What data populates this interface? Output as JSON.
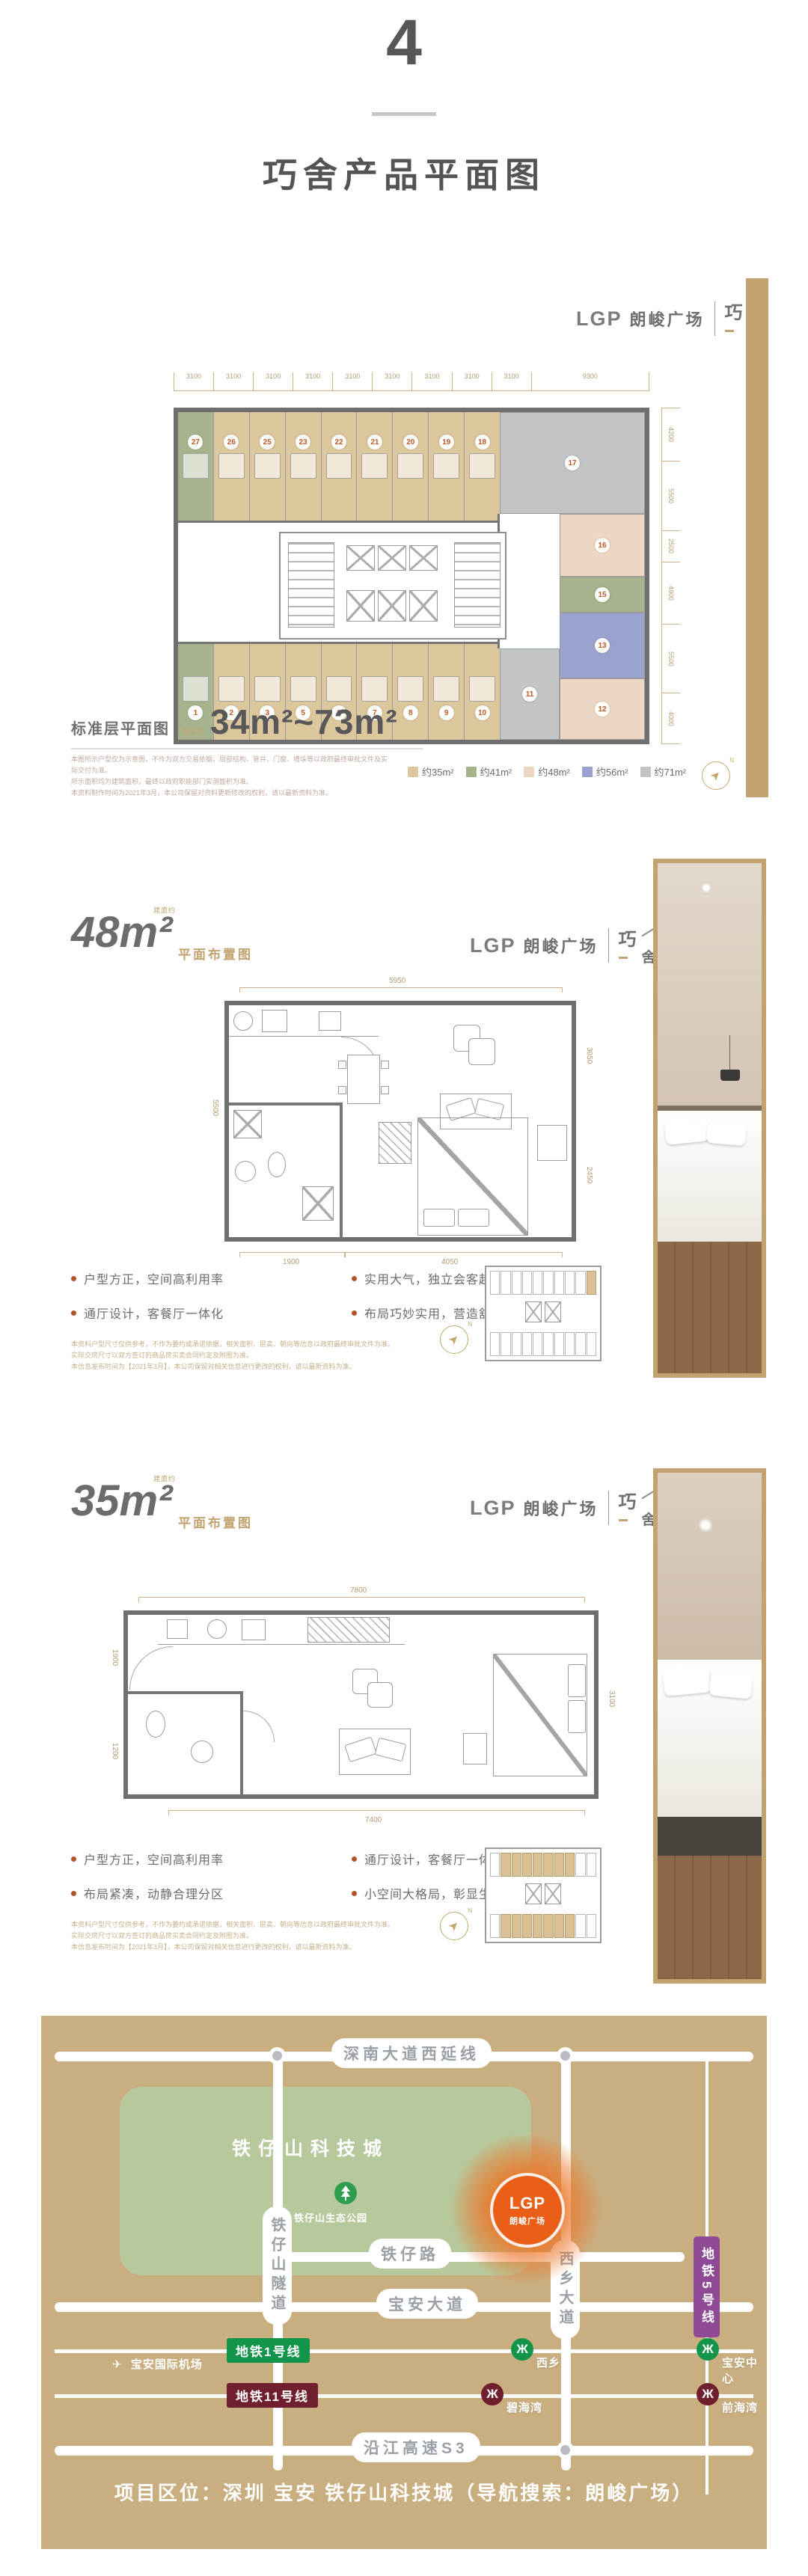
{
  "page": {
    "section_number": "4",
    "title": "巧舍产品平面图"
  },
  "brand": {
    "logo": "LGP",
    "name": "朗峻广场",
    "sub1": "巧",
    "sub2": "舍"
  },
  "icons": {
    "metro": "Ж",
    "plane": "✈",
    "north_arrow": "➤",
    "north": "N"
  },
  "colors": {
    "gold": "#c2a370",
    "t35": "#dcc69c",
    "t41": "#a6b38c",
    "t48": "#eed6c5",
    "t56": "#9aa3cf",
    "t71": "#c2c5c7",
    "metro1": "#12954a",
    "metro11": "#6f1f2d",
    "metro5": "#8f4a96",
    "project_orange": "#e95f17"
  },
  "section1": {
    "plan_label": "标准层平面图",
    "area_prefix": "建面约",
    "area_range": "34m²~73m²",
    "top_dims": [
      "3100",
      "3100",
      "3100",
      "3100",
      "3100",
      "3100",
      "3100",
      "3100",
      "3100",
      "9300"
    ],
    "right_dims": [
      "4200",
      "5500",
      "2500",
      "4900",
      "5500",
      "4000"
    ],
    "top_units": [
      {
        "no": "27",
        "t": "t41"
      },
      {
        "no": "26",
        "t": "t35"
      },
      {
        "no": "25",
        "t": "t35"
      },
      {
        "no": "23",
        "t": "t35"
      },
      {
        "no": "22",
        "t": "t35"
      },
      {
        "no": "21",
        "t": "t35"
      },
      {
        "no": "20",
        "t": "t35"
      },
      {
        "no": "19",
        "t": "t35"
      },
      {
        "no": "18",
        "t": "t35"
      }
    ],
    "unit17": {
      "no": "17",
      "t": "t71"
    },
    "unit11": {
      "no": "11",
      "t": "t71"
    },
    "bottom_units": [
      {
        "no": "1",
        "t": "t41"
      },
      {
        "no": "2",
        "t": "t35"
      },
      {
        "no": "3",
        "t": "t35"
      },
      {
        "no": "5",
        "t": "t35"
      },
      {
        "no": "6",
        "t": "t35"
      },
      {
        "no": "7",
        "t": "t35"
      },
      {
        "no": "8",
        "t": "t35"
      },
      {
        "no": "9",
        "t": "t35"
      },
      {
        "no": "10",
        "t": "t35"
      }
    ],
    "right_units": [
      {
        "no": "16",
        "t": "t48",
        "h": 84
      },
      {
        "no": "15",
        "t": "t41",
        "h": 48
      },
      {
        "no": "13",
        "t": "t56",
        "h": 88
      },
      {
        "no": "12",
        "t": "t48",
        "h": 82
      }
    ],
    "legend": [
      {
        "label": "约35m²",
        "t": "t35"
      },
      {
        "label": "约41m²",
        "t": "t41"
      },
      {
        "label": "约48m²",
        "t": "t48"
      },
      {
        "label": "约56m²",
        "t": "t56"
      },
      {
        "label": "约71m²",
        "t": "t71"
      }
    ],
    "disclaimer": [
      "本图所示户型仅为示意图，不作为双方交易依据，局部结构、管井、门窗、墙垛等以政府最终审批文件及实际交付为准。",
      "所示面积均为建筑面积，最终以政府职能部门实测面积为准。",
      "本资料制作时间为2021年3月，本公司保留对资料更新修改的权利，请以最新资料为准。"
    ]
  },
  "section48": {
    "area": "48m²",
    "area_prefix": "建面约",
    "sub_label": "平面布置图",
    "dims": {
      "top": "5950",
      "left": "5500",
      "right_top": "3050",
      "right_bottom": "2450",
      "bottom_left": "1900",
      "bottom_right": "4050"
    },
    "features": [
      "户型方正，空间高利用率",
      "通厅设计，客餐厅一体化",
      "实用大气，独立会客起居",
      "布局巧妙实用，营造舒适空间"
    ],
    "disclaimer": [
      "本资料户型尺寸仅供参考，不作为要约或承诺依据，相关面积、层高、朝向等信息以政府最终审批文件为准。",
      "实际交房尺寸以双方签订的商品房买卖合同约定及附图为准。",
      "本信息发布时间为【2021年3月】，本公司保留对相关信息进行更改的权利，请以最新资料为准。"
    ],
    "locator": {
      "top_highlight": [
        9
      ],
      "bottom_highlight": []
    }
  },
  "section35": {
    "area": "35m²",
    "area_prefix": "建面约",
    "sub_label": "平面布置图",
    "dims": {
      "top": "7800",
      "left_top": "1900",
      "left_bottom": "1200",
      "right": "3100",
      "bottom": "7400"
    },
    "features": [
      "户型方正，空间高利用率",
      "布局紧凑，动静合理分区",
      "通厅设计，客餐厅一体化",
      "小空间大格局，彰显生活格调"
    ],
    "disclaimer": [
      "本资料户型尺寸仅供参考，不作为要约或承诺依据，相关面积、层高、朝向等信息以政府最终审批文件为准。",
      "实际交房尺寸以双方签订的商品房买卖合同约定及附图为准。",
      "本信息发布时间为【2021年3月】，本公司保留对相关信息进行更改的权利，请以最新资料为准。"
    ],
    "locator": {
      "top_highlight": [
        1,
        2,
        3,
        4,
        5,
        6,
        7
      ],
      "bottom_highlight": [
        1,
        2,
        3,
        4,
        5,
        6,
        7
      ]
    }
  },
  "map": {
    "road_shennan": "深南大道西延线",
    "road_tiezai": "铁仔路",
    "road_baoan": "宝安大道",
    "road_yanjiang": "沿江高速S3",
    "road_tunnel": "铁仔山隧道",
    "road_xixiang": "西乡大道",
    "metro5_label": "地铁5号线",
    "metro1": {
      "label": "地铁1号线",
      "stations": [
        "西乡",
        "宝安中心"
      ]
    },
    "metro11": {
      "label": "地铁11号线",
      "stations": [
        "碧海湾",
        "前海湾"
      ]
    },
    "tech_city": "铁仔山科技城",
    "park": "铁仔山生态公园",
    "airport": "宝安国际机场",
    "project_logo": "LGP",
    "project_name": "朗峻广场",
    "footer": "项目区位：深圳 宝安 铁仔山科技城（导航搜索：朗峻广场）"
  }
}
